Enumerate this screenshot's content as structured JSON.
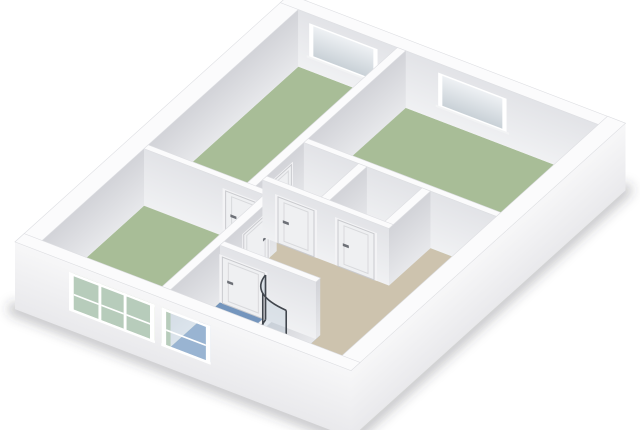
{
  "meta": {
    "app_name": "floorplan-3d-viewer",
    "view": "3d-isometric-floorplan",
    "visible_text": ""
  },
  "canvas": {
    "width": 640,
    "height": 430,
    "background": "#ffffff"
  },
  "projection": {
    "origin": [
      15,
      299
    ],
    "u_axis": [
      30.5,
      -27.5
    ],
    "v_axis": [
      60,
      23
    ],
    "z_scale_px": 22.4,
    "wall_height_m": 2.55
  },
  "palette": {
    "wall_top": "#fbfbfc",
    "wall_top_edge": "#dddee2",
    "face_u_light": "#e7e8eb",
    "face_u_dark": "#d2d3d8",
    "face_v_light": "#f0f1f3",
    "face_v_dark": "#e2e3e7",
    "outer_bottom": "#e9e9ec",
    "outer_top": "#f7f7f8",
    "floor_room": "#a8bd97",
    "floor_bath": "#7495bd",
    "floor_hall": "#cdc3ae",
    "door_frame": "#f3f3f5",
    "door_fill": "#eff0f2",
    "door_stroke": "#c9cace",
    "door_panel": "#d8d9dc",
    "door_handle": "#6d7077",
    "window_frame": "#ffffff",
    "glass_far_bottom": "#c9d1d7",
    "glass_far_top": "#eef1f4",
    "glass_near": "rgba(205,224,238,0.42)",
    "sill": "#f2f3f4",
    "shower_frame": "#41464d",
    "shower_glass": "rgba(190,206,218,0.40)",
    "fixture_white": "#fcfcfd",
    "fixture_stroke": "#b9bcc2",
    "fixture_seat": "#f3f5f7",
    "shadow": "rgba(55,58,64,0.28)"
  },
  "rooms": [
    {
      "name": "hallway",
      "color": "floor_hall",
      "rect": [
        0.3,
        2.44,
        3.78,
        5.3
      ]
    },
    {
      "name": "hallway-east",
      "color": "floor_hall",
      "rect": [
        3.5,
        2.09,
        5.5,
        5.3
      ]
    },
    {
      "name": "bathroom",
      "color": "floor_bath",
      "rect": [
        0.3,
        2.44,
        2.06,
        4.04
      ]
    },
    {
      "name": "living-room",
      "color": "floor_room",
      "rect": [
        0.3,
        0.3,
        3.78,
        2.44
      ]
    },
    {
      "name": "bedroom-top",
      "color": "floor_room",
      "rect": [
        3.5,
        0.3,
        8.7,
        2.09
      ]
    },
    {
      "name": "bedroom-right",
      "color": "floor_room",
      "rect": [
        5.36,
        2.09,
        8.7,
        5.3
      ]
    }
  ],
  "walls_back": [
    {
      "name": "exterior-back-left",
      "kind": "u",
      "c": 0.3,
      "t": 0.3,
      "a": [
        0,
        9
      ],
      "f": [
        0.3,
        8.7
      ],
      "grad": "gu"
    },
    {
      "name": "exterior-back-right",
      "kind": "v",
      "c": 8.7,
      "t": 0.3,
      "a": [
        0,
        5.6
      ],
      "f": [
        0.3,
        5.3
      ],
      "grad": "gv",
      "windows_far": {
        "openings": [
          [
            0.55,
            1.55
          ],
          [
            2.7,
            3.7
          ]
        ],
        "z": [
          0.72,
          2.06
        ],
        "border": 0.07
      }
    },
    {
      "name": "wall-top-bedroom",
      "kind": "u",
      "c": 2.09,
      "t": 0.14,
      "a": [
        3.64,
        8.7
      ],
      "f": [
        3.72,
        8.7
      ],
      "grad": "gu",
      "doors": [
        {
          "a": [
            4.15,
            4.95
          ],
          "name": "door-top-bedroom",
          "handle": "right"
        }
      ]
    },
    {
      "name": "wall-living-right",
      "kind": "v",
      "c": 3.64,
      "t": 0.14,
      "a": [
        0.3,
        2.44
      ],
      "f": [
        0.3,
        2.44
      ],
      "grad": "gv",
      "doors": [
        {
          "a": [
            1.66,
            2.26
          ],
          "name": "door-living-side",
          "handle": "left"
        }
      ]
    },
    {
      "name": "wall-living-bottom",
      "kind": "u",
      "c": 2.44,
      "t": 0.14,
      "a": [
        0.3,
        3.78
      ],
      "f": [
        0.3,
        3.78
      ],
      "grad": "gu",
      "doors": [
        {
          "a": [
            2.7,
            3.5
          ],
          "name": "door-living-room",
          "handle": "right"
        }
      ]
    },
    {
      "name": "wall-bedroom-right-left",
      "kind": "v",
      "c": 5.36,
      "t": 0.14,
      "a": [
        2.09,
        5.3
      ],
      "f": [
        2.09,
        5.3
      ],
      "grad": "gv"
    },
    {
      "name": "wall-closet-divider",
      "kind": "u",
      "c": 3.14,
      "t": 0.14,
      "a": [
        4.14,
        5.36
      ],
      "f": [
        4.14,
        5.36
      ],
      "grad": "gu"
    },
    {
      "name": "wall-closet-bottom",
      "kind": "u",
      "c": 4.2,
      "t": 0.14,
      "a": [
        4.0,
        5.36
      ],
      "f": [
        4.0,
        5.36
      ],
      "grad": "gu"
    },
    {
      "name": "wall-closet-left",
      "kind": "v",
      "c": 4.0,
      "t": 0.14,
      "a": [
        2.09,
        4.2
      ],
      "f": [
        2.09,
        4.2
      ],
      "grad": "gv",
      "doors": [
        {
          "a": [
            2.35,
            2.95
          ],
          "name": "door-closet-1",
          "handle": "left"
        },
        {
          "a": [
            3.35,
            3.95
          ],
          "name": "door-closet-2",
          "handle": "left"
        }
      ]
    },
    {
      "name": "wall-bathroom-bottom",
      "kind": "u",
      "c": 4.04,
      "t": 0.14,
      "a": [
        0.3,
        2.06
      ],
      "f": [
        0.3,
        2.06
      ],
      "grad": "gu"
    },
    {
      "name": "wall-bathroom-right",
      "kind": "v",
      "c": 1.92,
      "t": 0.14,
      "a": [
        2.44,
        4.04
      ],
      "f": [
        2.44,
        4.04
      ],
      "grad": "gv",
      "doors": [
        {
          "a": [
            2.48,
            3.18
          ],
          "name": "door-bathroom",
          "handle": "left"
        }
      ]
    }
  ],
  "fixtures": {
    "toilet": {
      "shadow": {
        "c": [
          0.74,
          3.45
        ],
        "rx": 0.36,
        "ry": 0.42
      },
      "tank": [
        0.32,
        3.13,
        0.56,
        3.77
      ],
      "bowl": {
        "c": [
          0.8,
          3.45
        ],
        "rx": 0.27,
        "ry": 0.31
      },
      "seat": {
        "c": [
          0.82,
          3.45
        ],
        "rx": 0.16,
        "ry": 0.2
      },
      "lift_px": 9
    },
    "shower": {
      "corner": [
        1.92,
        3.9
      ],
      "radius": 0.7,
      "height_m": 2.0
    }
  },
  "walls_front": [
    {
      "name": "exterior-front-right",
      "kind": "u",
      "c": 5.6,
      "t": 0.3,
      "a": [
        0,
        9
      ],
      "f": [
        0,
        9
      ],
      "grad": "gouter",
      "zmin": -0.45
    },
    {
      "name": "exterior-front-left",
      "kind": "v",
      "c": 0,
      "t": 0.3,
      "a": [
        0,
        5.6
      ],
      "f": [
        0,
        5.6
      ],
      "grad": "gouter",
      "zmin": -0.45,
      "windows_near": {
        "bands": [
          [
            0.9,
            2.33
          ],
          [
            2.44,
            3.26
          ]
        ],
        "band_z": [
          0.42,
          2.14
        ],
        "panes": [
          [
            0.98,
            1.39
          ],
          [
            1.44,
            1.81
          ],
          [
            1.86,
            2.25
          ],
          [
            2.52,
            3.18
          ]
        ],
        "glass_z": [
          0.54,
          2.02
        ],
        "rail_z": [
          1.16,
          1.24
        ]
      }
    }
  ],
  "shadow": {
    "points": [
      [
        15,
        309
      ],
      [
        351,
        438
      ],
      [
        625,
        190
      ]
    ],
    "width": 14,
    "blur": 5.5
  }
}
